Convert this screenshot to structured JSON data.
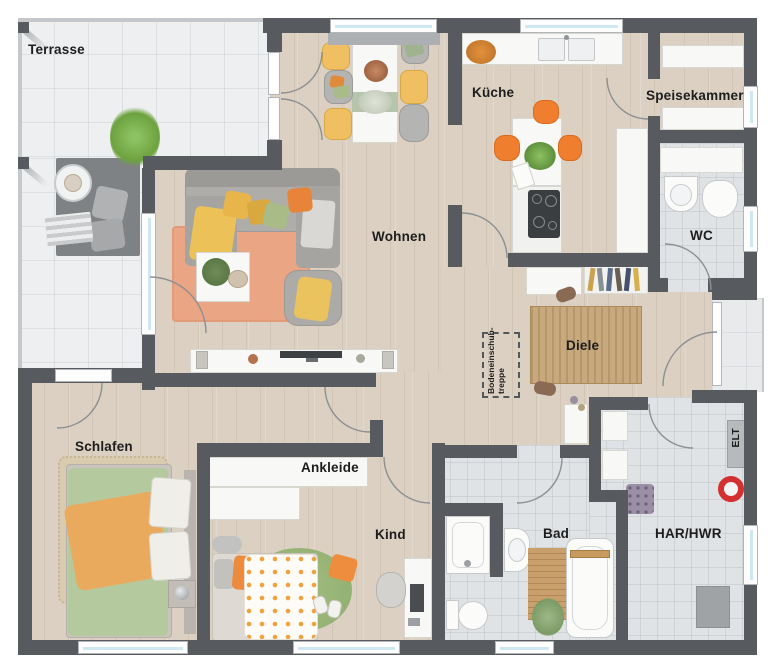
{
  "rooms": {
    "terrasse": "Terrasse",
    "kueche": "Küche",
    "speisekammer": "Speisekammer",
    "wc": "WC",
    "wohnen": "Wohnen",
    "diele": "Diele",
    "schlafen": "Schlafen",
    "ankleide": "Ankleide",
    "kind": "Kind",
    "bad": "Bad",
    "har_hwr": "HAR/HWR",
    "elt": "ELT"
  },
  "annotations": {
    "attic_hatch_line1": "Bodeneinschub-",
    "attic_hatch_line2": "treppe"
  },
  "colors": {
    "wall": "#575b5f",
    "wood_floor": "#dbd0c2",
    "terrace_tile": "#edeff0",
    "bath_tile": "#e0e3e5",
    "window_glass": "#cfe7f0",
    "accent_orange": "#ee8434",
    "accent_yellow": "#ecc058",
    "accent_green": "#a9bb86",
    "rug_living": "#eaa585",
    "rug_hall": "#c8a97e"
  }
}
